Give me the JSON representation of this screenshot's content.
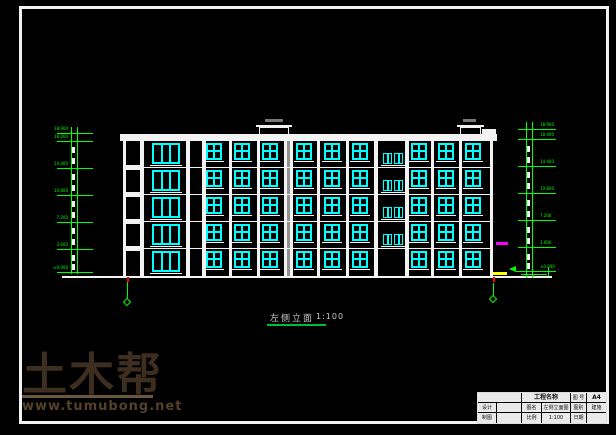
{
  "colors": {
    "background": "#000000",
    "line_white": "#f2f2f2",
    "window_cyan": "#00ffff",
    "dimension_green": "#00ff00",
    "axis_red": "#ff0000",
    "accent_magenta": "#ff00ff",
    "accent_yellow": "#ffff00",
    "joint_grey": "#909090",
    "roof_tag_grey": "#777777",
    "watermark_logo": "#3e2e20",
    "watermark_url": "#55402b",
    "title_grey": "#c9c9c9",
    "underline_green": "#00bb33"
  },
  "drawing_title": {
    "name": "左侧立面",
    "scale": "1:100"
  },
  "watermark": {
    "logo": "土木帮",
    "url": "www.tumubong.net"
  },
  "title_block": {
    "project_label": "工程名称",
    "sheet_no_label": "图 号",
    "sheet_no_value": "A4",
    "drawing_name_label": "图名",
    "drawing_name_value": "左侧立面图",
    "category_label": "图别",
    "category_value": "建施",
    "scale_label": "比例",
    "scale_value": "1:100",
    "date_label": "日期",
    "designer_label": "设计",
    "drafter_label": "制图"
  },
  "geometry": {
    "facade": {
      "left": 123,
      "right": 493,
      "top": 141,
      "bottom": 277
    },
    "parapet": {
      "x": 120,
      "w": 377,
      "y": 134,
      "h": 7
    },
    "parapet_step": {
      "x": 482,
      "w": 14,
      "y": 129,
      "h": 6
    },
    "mullions": [
      [
        140,
        4
      ],
      [
        186,
        4
      ],
      [
        202,
        4
      ],
      [
        229,
        3
      ],
      [
        257,
        3
      ],
      [
        317,
        3
      ],
      [
        346,
        3
      ],
      [
        374,
        4
      ],
      [
        405,
        4
      ],
      [
        431,
        3
      ],
      [
        459,
        3
      ]
    ],
    "joint": {
      "x": 284,
      "w": 9
    },
    "floor_lines_y": [
      167,
      194,
      221,
      248
    ],
    "spandrel": {
      "x": 126,
      "w": 14,
      "h": 5
    },
    "window_rows_y": [
      143,
      170,
      197,
      224,
      251
    ],
    "tall": {
      "x": 152,
      "w": 28,
      "h": 21
    },
    "square_cols_x": [
      206,
      234,
      262,
      296,
      324,
      352,
      411,
      438,
      465
    ],
    "square": {
      "w": 16,
      "h": 17
    },
    "stair": {
      "cols_x": [
        383,
        394
      ],
      "w": 9,
      "h": 11,
      "rows_y": [
        153,
        180,
        207,
        234
      ],
      "sill_x": 381,
      "sill_w": 24
    },
    "roof_structures": [
      {
        "x": 259,
        "w": 30,
        "lip_x": 256,
        "lip_w": 36,
        "tag_x": 265,
        "tag_w": 18
      },
      {
        "x": 460,
        "w": 21,
        "lip_x": 457,
        "lip_w": 27,
        "tag_x": 463,
        "tag_w": 13
      }
    ],
    "ground": {
      "x": 62,
      "w": 490,
      "y": 276,
      "h": 2
    }
  },
  "dimensions": {
    "columns": [
      {
        "side": "left",
        "lines_x": [
          71,
          77
        ],
        "line_top": 127,
        "line_bottom": 274,
        "tick_x": 57,
        "tick_w": 36,
        "label_x": 38,
        "label_w": 30,
        "align": "right",
        "dash_x": 72,
        "levels": [
          {
            "y": 133,
            "label": "18.900"
          },
          {
            "y": 141,
            "label": "18.000"
          },
          {
            "y": 168,
            "label": "14.400"
          },
          {
            "y": 195,
            "label": "10.800"
          },
          {
            "y": 222,
            "label": "7.200"
          },
          {
            "y": 249,
            "label": "3.600"
          },
          {
            "y": 272,
            "label": "±0.000"
          }
        ],
        "dashes_y": [
          147,
          158,
          174,
          185,
          201,
          212,
          228,
          239,
          255,
          264
        ]
      },
      {
        "side": "right",
        "lines_x": [
          526,
          532
        ],
        "line_top": 122,
        "line_bottom": 278,
        "tick_x": 518,
        "tick_w": 38,
        "label_x": 540,
        "label_w": 30,
        "align": "left",
        "dash_x": 527,
        "levels": [
          {
            "y": 129,
            "label": "18.900"
          },
          {
            "y": 139,
            "label": "18.000"
          },
          {
            "y": 166,
            "label": "14.400"
          },
          {
            "y": 193,
            "label": "10.800"
          },
          {
            "y": 220,
            "label": "7.200"
          },
          {
            "y": 247,
            "label": "3.600"
          },
          {
            "y": 271,
            "label": "±0.000"
          }
        ],
        "dashes_y": [
          146,
          157,
          172,
          183,
          200,
          211,
          227,
          238,
          254,
          263
        ]
      }
    ]
  },
  "axis_markers": [
    {
      "x": 127,
      "red_y": 277,
      "line_y1": 282,
      "line_y2": 299,
      "diamond_y": 299
    },
    {
      "x": 493,
      "red_y": 277,
      "line_y1": 283,
      "line_y2": 296,
      "diamond_y": 296
    }
  ]
}
